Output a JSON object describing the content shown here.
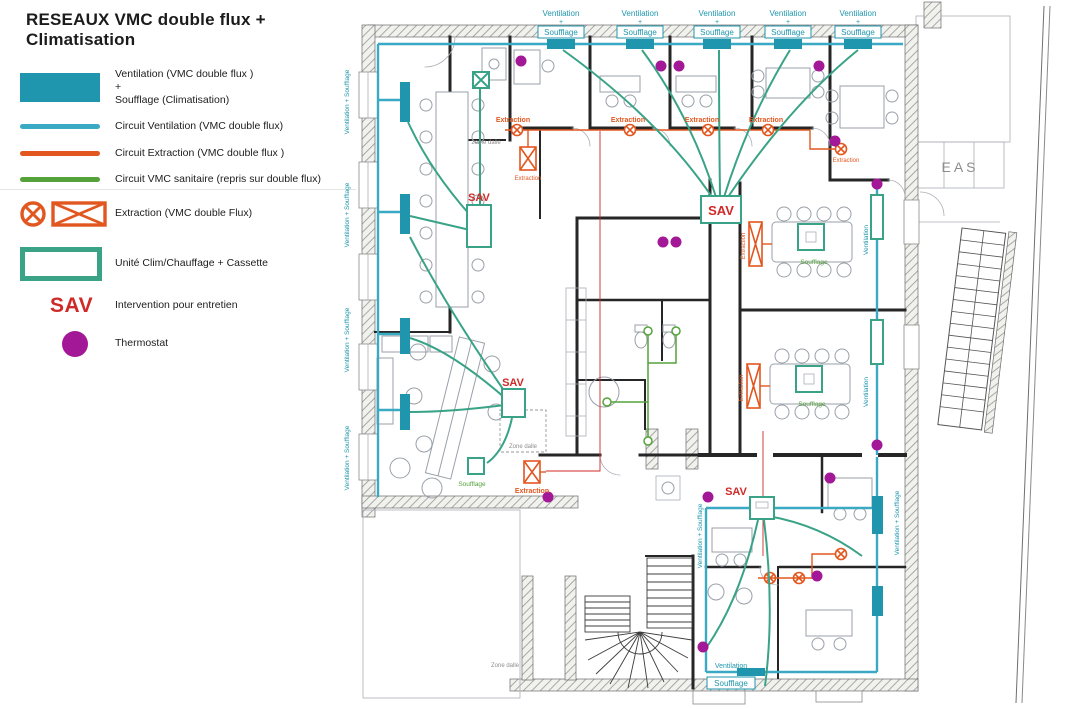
{
  "title": "RESEAUX VMC double flux + Climatisation",
  "legend": {
    "items": [
      {
        "type": "swatch-filled",
        "line1": "Ventilation (VMC double flux )",
        "line2": "+",
        "line3": "Soufflage (Climatisation)"
      },
      {
        "type": "line-teal",
        "label": "Circuit Ventilation (VMC double flux)"
      },
      {
        "type": "line-orange",
        "label": "Circuit Extraction (VMC double flux )"
      },
      {
        "type": "line-green",
        "label": "Circuit VMC sanitaire (repris sur double flux)"
      },
      {
        "type": "extraction-symbols",
        "label": "Extraction (VMC double Flux)"
      },
      {
        "type": "unit-outline",
        "label": "Unité Clim/Chauffage + Cassette"
      },
      {
        "type": "sav",
        "symbol": "SAV",
        "label": "Intervention pour entretien"
      },
      {
        "type": "thermostat",
        "label": "Thermostat"
      }
    ]
  },
  "plan": {
    "labels": {
      "ventilation": "Ventilation",
      "plus": "+",
      "soufflage": "Soufflage",
      "ventilation_plus_soufflage": "Ventilation + Soufflage",
      "extraction": "Extraction",
      "sav": "SAV",
      "eas": "EAS",
      "zone_dalle": "Zone dalle",
      "deuxieme_dalle": "2eme dalle"
    },
    "colors": {
      "ventilation_teal": "#1f96ad",
      "circuit_ventilation": "#3aa9c4",
      "circuit_extraction": "#e2571f",
      "circuit_sanitaire": "#55a23b",
      "unit_green": "#3aa387",
      "sav_red": "#cf2a27",
      "thermostat_purple": "#a21896"
    }
  }
}
